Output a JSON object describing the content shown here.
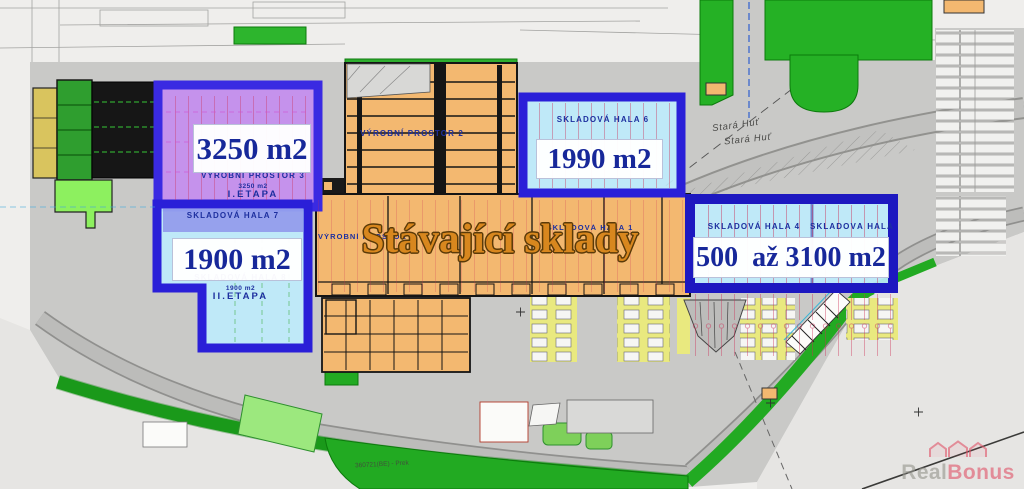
{
  "highlights": {
    "prostor3": {
      "big_area": "3250 m2",
      "name": "VÝROBNÍ PROSTOR 3",
      "small_area": "3250 m2",
      "stage": "I.ETAPA"
    },
    "hala7": {
      "name": "SKLADOVÁ HALA 7"
    },
    "hala8": {
      "big_area": "1900 m2",
      "name": "SKLADOVÁ HALA 8",
      "small_area": "1900 m2",
      "stage": "II.ETAPA"
    },
    "hala6": {
      "big_area": "1990 m2",
      "name": "SKLADOVÁ HALA 6"
    },
    "hala45": {
      "big_area": "500  až 3100 m2",
      "name_hala4": "SKLADOVÁ HALA 4",
      "name_hala5": "SKLADOVÁ HALA 5"
    }
  },
  "plan_labels": {
    "headline": "Stávající sklady",
    "vyrobni_prostor_2": "VÝROBNÍ PROSTOR 2",
    "vyrobni_prostor_1": "VÝROBNÍ PROSTOR 1",
    "skladova_hala_1": "SKLADOVÁ HALA 1",
    "street_1": "Stará Huť",
    "street_2": "Stará Huť",
    "parcel_note": "360721(BE) - Prek"
  },
  "watermark": {
    "text_gray": "Real",
    "text_red": "Bonus"
  },
  "colors": {
    "highlight_border_blue": "#2a1fd8",
    "highlight_fill_cyan": "#c2ecfa",
    "highlight_fill_purple": "#c48cf0",
    "building_orange": "#f3b870",
    "label_navy": "#1b2a9e",
    "headline_orange": "#d8871e",
    "grass_green": "#25b125",
    "parking_yellow": "#e9e97f",
    "dimension_red": "#cc2d55"
  }
}
